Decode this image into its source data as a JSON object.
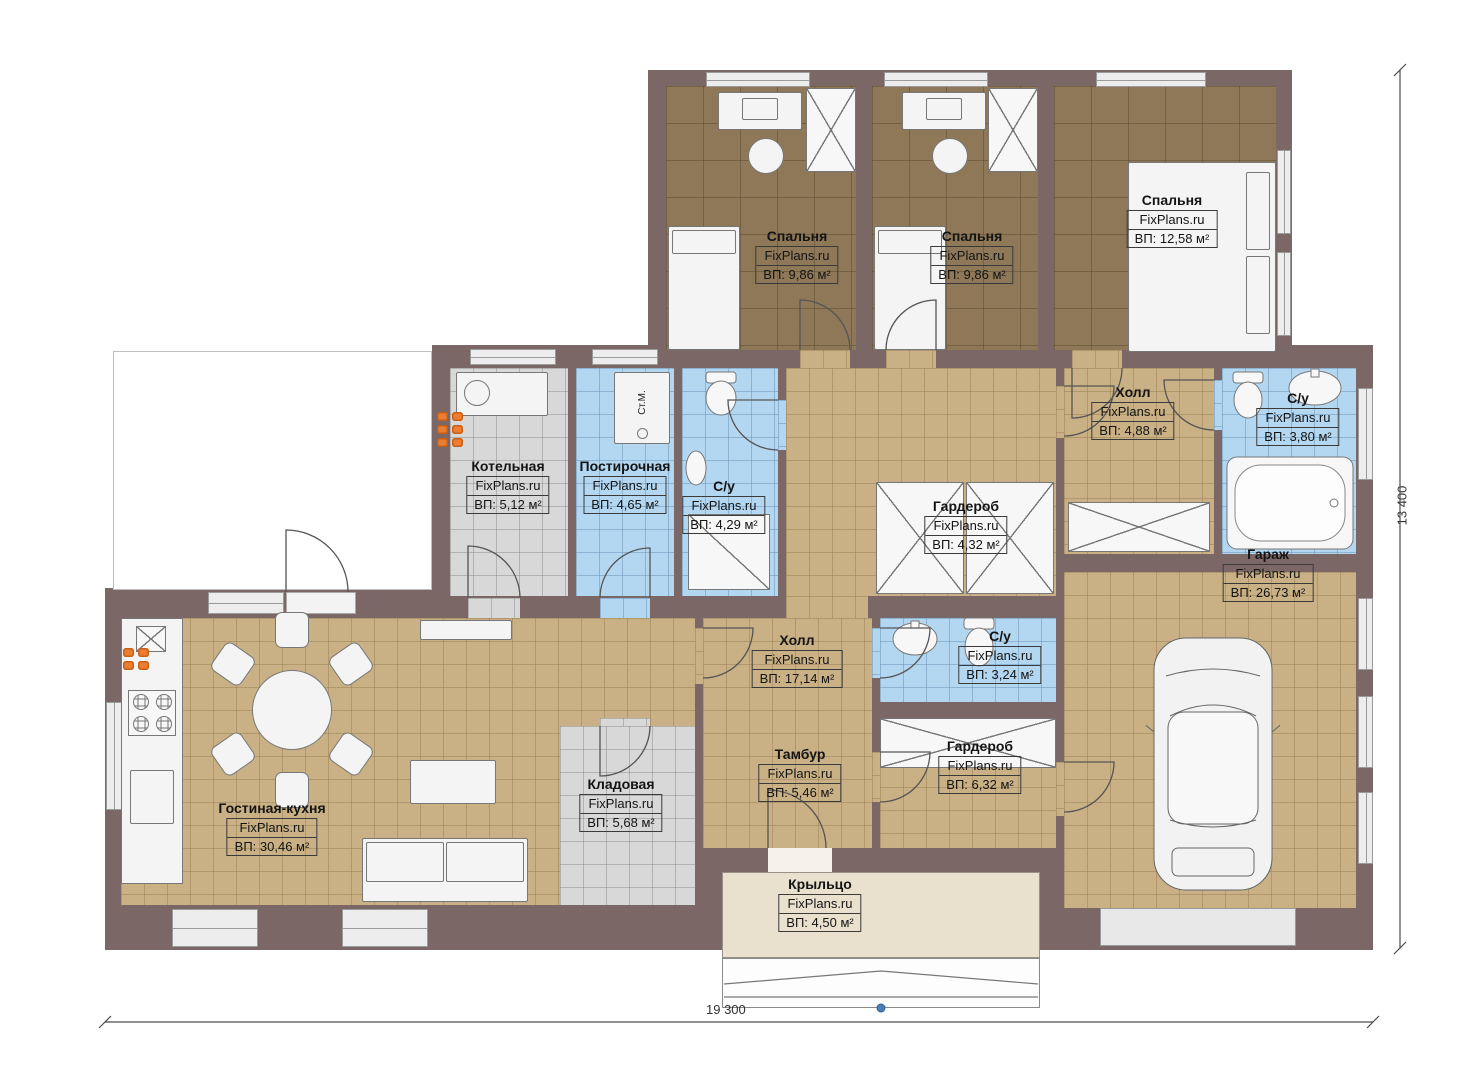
{
  "rooms": [
    {
      "name": "Спальня",
      "watermark": "FixPlans.ru",
      "area": "ВП: 9,86 м²"
    },
    {
      "name": "Спальня",
      "watermark": "FixPlans.ru",
      "area": "ВП: 9,86 м²"
    },
    {
      "name": "Спальня",
      "watermark": "FixPlans.ru",
      "area": "ВП: 12,58 м²"
    },
    {
      "name": "Котельная",
      "watermark": "FixPlans.ru",
      "area": "ВП: 5,12 м²"
    },
    {
      "name": "Постирочная",
      "watermark": "FixPlans.ru",
      "area": "ВП: 4,65 м²"
    },
    {
      "name": "С/у",
      "watermark": "FixPlans.ru",
      "area": "ВП: 4,29 м²"
    },
    {
      "name": "Холл",
      "watermark": "FixPlans.ru",
      "area": "ВП: 4,88 м²"
    },
    {
      "name": "С/у",
      "watermark": "FixPlans.ru",
      "area": "ВП: 3,80 м²"
    },
    {
      "name": "Гардероб",
      "watermark": "FixPlans.ru",
      "area": "ВП: 4,32 м²"
    },
    {
      "name": "Гараж",
      "watermark": "FixPlans.ru",
      "area": "ВП: 26,73 м²"
    },
    {
      "name": "Холл",
      "watermark": "FixPlans.ru",
      "area": "ВП: 17,14 м²"
    },
    {
      "name": "С/у",
      "watermark": "FixPlans.ru",
      "area": "ВП: 3,24 м²"
    },
    {
      "name": "Тамбур",
      "watermark": "FixPlans.ru",
      "area": "ВП: 5,46 м²"
    },
    {
      "name": "Гардероб",
      "watermark": "FixPlans.ru",
      "area": "ВП: 6,32 м²"
    },
    {
      "name": "Кладовая",
      "watermark": "FixPlans.ru",
      "area": "ВП: 5,68 м²"
    },
    {
      "name": "Гостиная-кухня",
      "watermark": "FixPlans.ru",
      "area": "ВП: 30,46 м²"
    },
    {
      "name": "Крыльцо",
      "watermark": "FixPlans.ru",
      "area": "ВП: 4,50 м²"
    }
  ],
  "annotations": {
    "washing_machine": "Ст.М."
  },
  "dimensions": {
    "bottom": "19 300",
    "right": "13 400"
  },
  "colors": {
    "wall": "#7b6866",
    "floor_wood": "#8e7857",
    "floor_tile": "#c9b185",
    "floor_wet": "#b4d7f1",
    "floor_utility": "#d8d8d8",
    "floor_porch": "#e9e0cd",
    "radiator": "#ed7d31",
    "fixture": "#f4f4f4"
  }
}
